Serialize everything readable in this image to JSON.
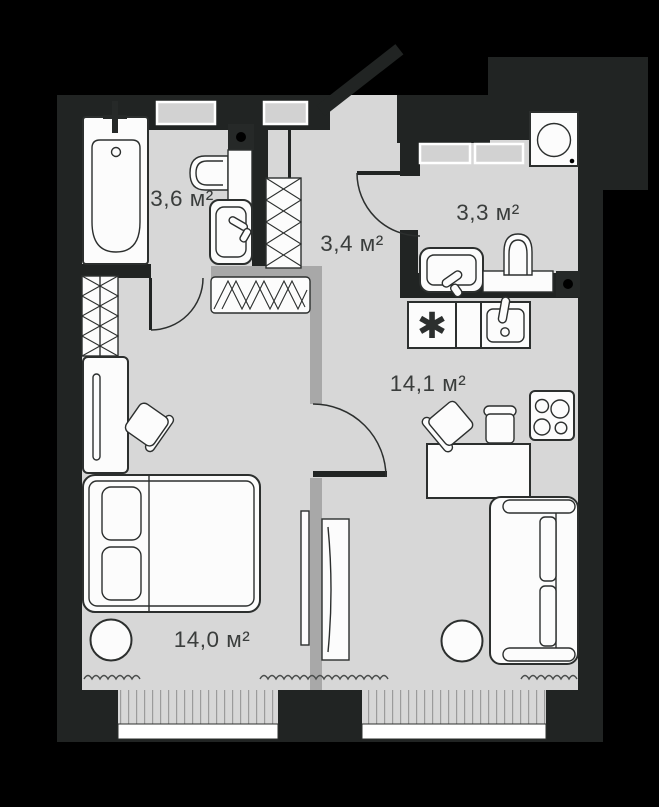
{
  "plan": {
    "type": "apartment-floor-plan",
    "rooms": [
      {
        "id": "bathroom",
        "label": "3,6 м²"
      },
      {
        "id": "hallway",
        "label": "3,4 м²"
      },
      {
        "id": "wc",
        "label": "3,3 м²"
      },
      {
        "id": "kitchen_living",
        "label": "14,1 м²"
      },
      {
        "id": "bedroom",
        "label": "14,0 м²"
      }
    ],
    "symbols": {
      "appliance_marker": "✱"
    },
    "colors": {
      "background": "#000000",
      "walls": "#212423",
      "floor": "#d7d7d7",
      "partition": "#a8a8a8",
      "furniture_outline": "#2c2f2e",
      "label_text": "#3a3d3c"
    }
  }
}
